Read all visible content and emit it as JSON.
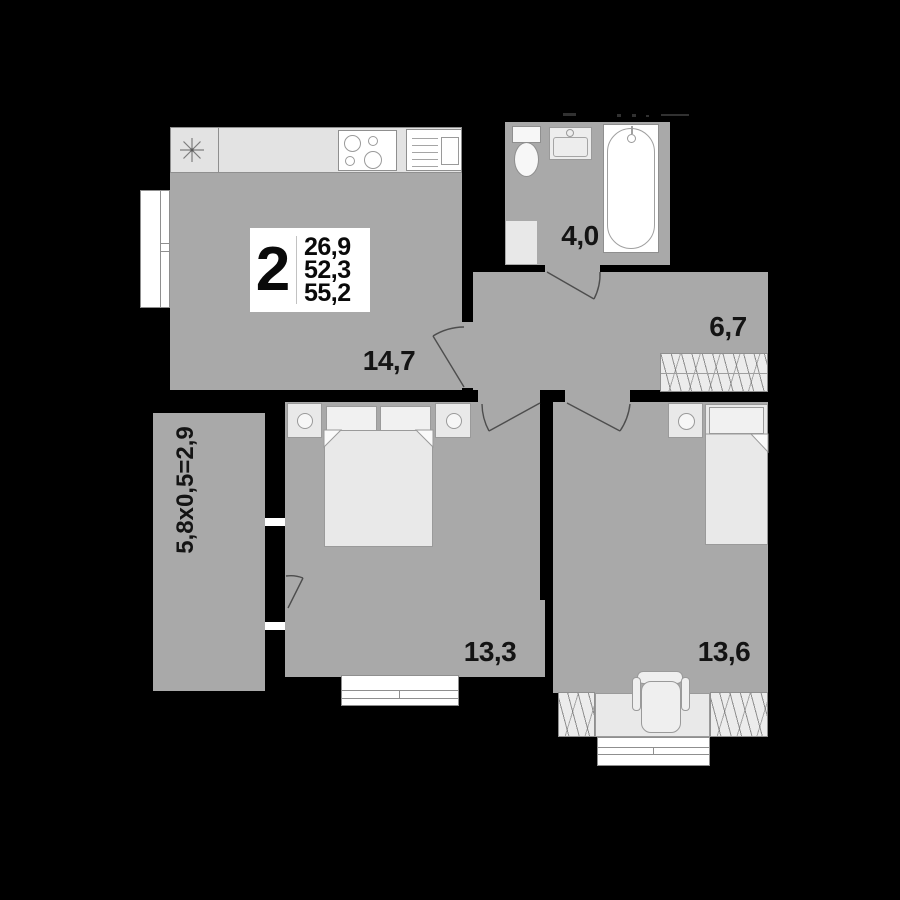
{
  "summary": {
    "rooms_count": "2",
    "values": [
      "26,9",
      "52,3",
      "55,2"
    ]
  },
  "room_labels": {
    "kitchen_living": "14,7",
    "bathroom": "4,0",
    "hallway": "6,7",
    "bedroom_1": "13,3",
    "bedroom_2": "13,6",
    "balcony": "5,8x0,5=2,9"
  },
  "colors": {
    "background": "#000000",
    "room_fill": "#a9a9a9",
    "furniture_fill": "#e9e9e9",
    "counter_fill": "#e3e3e3",
    "white": "#ffffff",
    "outline": "#8f8f8f",
    "label_text": "#141414"
  },
  "fixtures": [
    "refrigerator-star-icon",
    "cooktop-icon",
    "kitchen-sink-icon",
    "window-icon",
    "toilet-icon",
    "washbasin-icon",
    "bathtub-icon",
    "appliance-icon",
    "double-bed-icon",
    "nightstand-icon",
    "single-bed-icon",
    "desk-icon",
    "chair-icon",
    "wardrobe-hatch-icon",
    "door-swing-icon"
  ]
}
